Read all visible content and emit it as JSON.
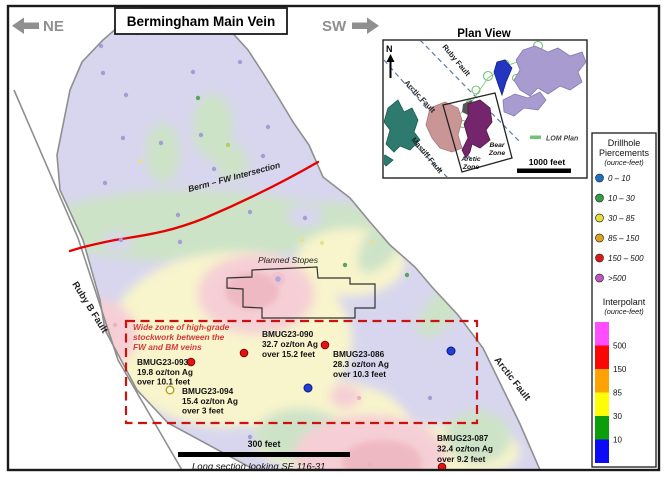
{
  "header": {
    "title": "Bermingham Main Vein",
    "direction_left": "NE",
    "direction_right": "SW"
  },
  "main_section": {
    "berm_fw_label": "Berm – FW Intersection",
    "ruby_b_fault_label": "Ruby B Fault",
    "arctic_fault_label": "Arctic Fault",
    "planned_stopes_label": "Planned Stopes",
    "highgrade_note_line1": "Wide zone of high-grade",
    "highgrade_note_line2": "stockwork between the",
    "highgrade_note_line3": "FW and BM veins",
    "scale_label": "300 feet",
    "caption": "Long section looking SE 116-31",
    "drillholes": [
      {
        "id": "BMUG23-090",
        "grade": "32.7 oz/ton Ag",
        "interval": "over 15.2 feet"
      },
      {
        "id": "BMUG23-086",
        "grade": "28.3 oz/ton Ag",
        "interval": "over 10.3 feet"
      },
      {
        "id": "BMUG23-093",
        "grade": "19.8 oz/ton Ag",
        "interval": "over 10.1 feet"
      },
      {
        "id": "BMUG23-094",
        "grade": "15.4 oz/ton Ag",
        "interval": "over 3 feet"
      },
      {
        "id": "BMUG23-087",
        "grade": "32.4 oz/ton Ag",
        "interval": "over 9.2 feet"
      }
    ]
  },
  "plan_view": {
    "title": "Plan View",
    "north_label": "N",
    "ruby_fault_label": "Ruby Fault",
    "arctic_fault_label": "Arctic Fault",
    "mastiff_fault_label": "Mastiff Fault",
    "arctic_zone_line1": "Arctic",
    "arctic_zone_line2": "Zone",
    "bear_zone_line1": "Bear",
    "bear_zone_line2": "Zone",
    "lom_plan_label": "LOM Plan",
    "scale_label": "1000 feet"
  },
  "legend": {
    "piercements_title_line1": "Drillhole",
    "piercements_title_line2": "Piercements",
    "piercements_units": "(ounce-feet)",
    "piercement_classes": [
      {
        "label": "0 – 10",
        "color": "#1d6fc2"
      },
      {
        "label": "10 – 30",
        "color": "#2f9e45"
      },
      {
        "label": "30 – 85",
        "color": "#e5dd30"
      },
      {
        "label": "85 – 150",
        "color": "#dba414"
      },
      {
        "label": "150 – 500",
        "color": "#e01717"
      },
      {
        "label": ">500",
        "color": "#c355c3"
      }
    ],
    "interpolant_title": "Interpolant",
    "interpolant_units": "(ounce-feet)",
    "interpolant_colors": [
      "#ff4dff",
      "#fb0505",
      "#ffa305",
      "#fdfd05",
      "#0b9e0b",
      "#0b0bf7"
    ],
    "interpolant_labels": [
      "500",
      "150",
      "85",
      "30",
      "10"
    ]
  },
  "colors": {
    "berm_line": "#e60000",
    "dashed_box": "#cc1111",
    "fault_line": "#8f8f8f",
    "base_lavender": "#d8d6ee"
  }
}
